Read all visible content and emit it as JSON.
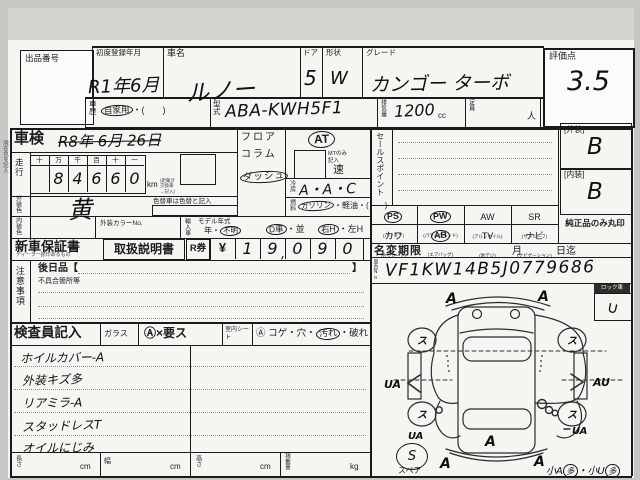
{
  "header": {
    "lot_label": "出品番号",
    "reg_label": "初度登録年月",
    "reg_value": "R1年6月",
    "name_label": "車名",
    "name_value": "ルノー",
    "door_label": "ドア",
    "door_value": "5",
    "shape_label": "形状",
    "shape_value": "W",
    "grade_label": "グレード",
    "grade_value": "カンゴー ターボ",
    "score_label": "評価点",
    "score_value": "3.5",
    "history_label": "車歴",
    "history_circled": "自家用",
    "history_paren": "・(　　)",
    "model_label": "型式",
    "model_value": "ABA-KWH5F1",
    "disp_label": "排気量",
    "disp_value": "1200",
    "disp_unit": "cc",
    "cap_label": "定員",
    "cap_unit": "人"
  },
  "left": {
    "margin_note": "現在色を記入",
    "shaken_label": "車検",
    "shaken_value": "R8年 6月 26日",
    "run_label": "走行",
    "run_headers": [
      "十",
      "万",
      "千",
      "百",
      "十",
      "一"
    ],
    "run_digits": [
      "",
      "8",
      "4",
      "6",
      "6",
      "0"
    ],
    "run_unit": "km",
    "run_note": "(距離計交換車→記入)",
    "ext_color_label": "外装色",
    "ext_color_value": "黄",
    "color_change_note": "色替車は色替と記入",
    "int_color_label": "内装色",
    "color_no_label": "外装カラーNo.",
    "import_label": "輸入車",
    "model_year_label": "モデル年式",
    "year_prefix": "年・",
    "year_circled": "不明",
    "dcar_circled": "D車",
    "dcar_rest": "・並",
    "rh_circled": "右H",
    "rh_rest": "・左H",
    "warranty_label": "新車保証書",
    "warranty_sub": "ディーラー捺印あるもの",
    "manual_label": "取扱説明書",
    "rticket_label": "R券",
    "yen": "¥",
    "price_digits": [
      "1",
      "9",
      "0",
      "9",
      "0"
    ],
    "price_comma": ",",
    "notice_label": "注意事項",
    "later_label": "後日品【",
    "later_close": "】",
    "defect_label": "不具合箇所等"
  },
  "right": {
    "floor": "フロア",
    "column": "コラム",
    "dash": "ダッシュ",
    "at": "AT",
    "mt_note": "MTのみ記入",
    "speed": "速",
    "sales_label": "セールスポイント",
    "cool_label": "冷房",
    "cool_value": "A・A・C",
    "fuel_label": "燃料",
    "fuel_circled": "ガソリン",
    "fuel_rest": "・軽油・(　　)",
    "ext_grade_label": "[外装]",
    "ext_grade_value": "B",
    "int_grade_label": "[内装]",
    "int_grade_value": "B",
    "equip": [
      {
        "l": "PS",
        "s": "(パワステ)"
      },
      {
        "l": "PW",
        "s": "(パワーウインド)"
      },
      {
        "l": "AW",
        "s": "(アルミホイル)"
      },
      {
        "l": "SR",
        "s": "(サンルーフ)"
      },
      {
        "l": "カワ",
        "s": "(カワシート)"
      },
      {
        "l": "AB",
        "s": "(エアバッグ)"
      },
      {
        "l": "TV",
        "s": "(地デジ)"
      },
      {
        "l": "ナビ",
        "s": "(ナビゲーション)"
      }
    ],
    "genuine_note": "純正品のみ丸印",
    "name_change_label": "名変期限",
    "month_label": "月",
    "day_label": "日迄",
    "vin_label": "車台No",
    "vin_value": "VF1KW14B5J0779686",
    "lock_label": "ロック車",
    "lock_mark": "∪"
  },
  "inspector": {
    "label": "検査員記入",
    "glass_label": "ガラス",
    "glass_opts": "Ⓐ×要ス",
    "seat_label": "室内シート",
    "seat_pre": "Ⓐ コゲ・穴・",
    "seat_circled": "汚れ",
    "seat_post": "・破れ",
    "notes": [
      "ホイルカバー-A",
      "外装キズ多",
      "リアミラ-A",
      "スタッドレスT",
      "オイルにじみ"
    ]
  },
  "diagram": {
    "front_left": "A",
    "front_right": "A",
    "side_left": "UA",
    "side_right": "AU",
    "rear_side_left": "UA",
    "rear_side_right": "UA",
    "rear_center": "A",
    "rear_corner_left": "A",
    "rear_corner_right": "A",
    "wheel": "ス",
    "spare_mark": "S",
    "spare_label": "スペア",
    "small_a": "小A",
    "small_a_circled": "多",
    "small_u": "・小U",
    "small_u_circled": "多"
  },
  "footer": {
    "length_label": "長さ",
    "width_label": "幅",
    "height_label": "高さ",
    "load_label": "積載量",
    "cm": "cm",
    "kg": "kg"
  }
}
